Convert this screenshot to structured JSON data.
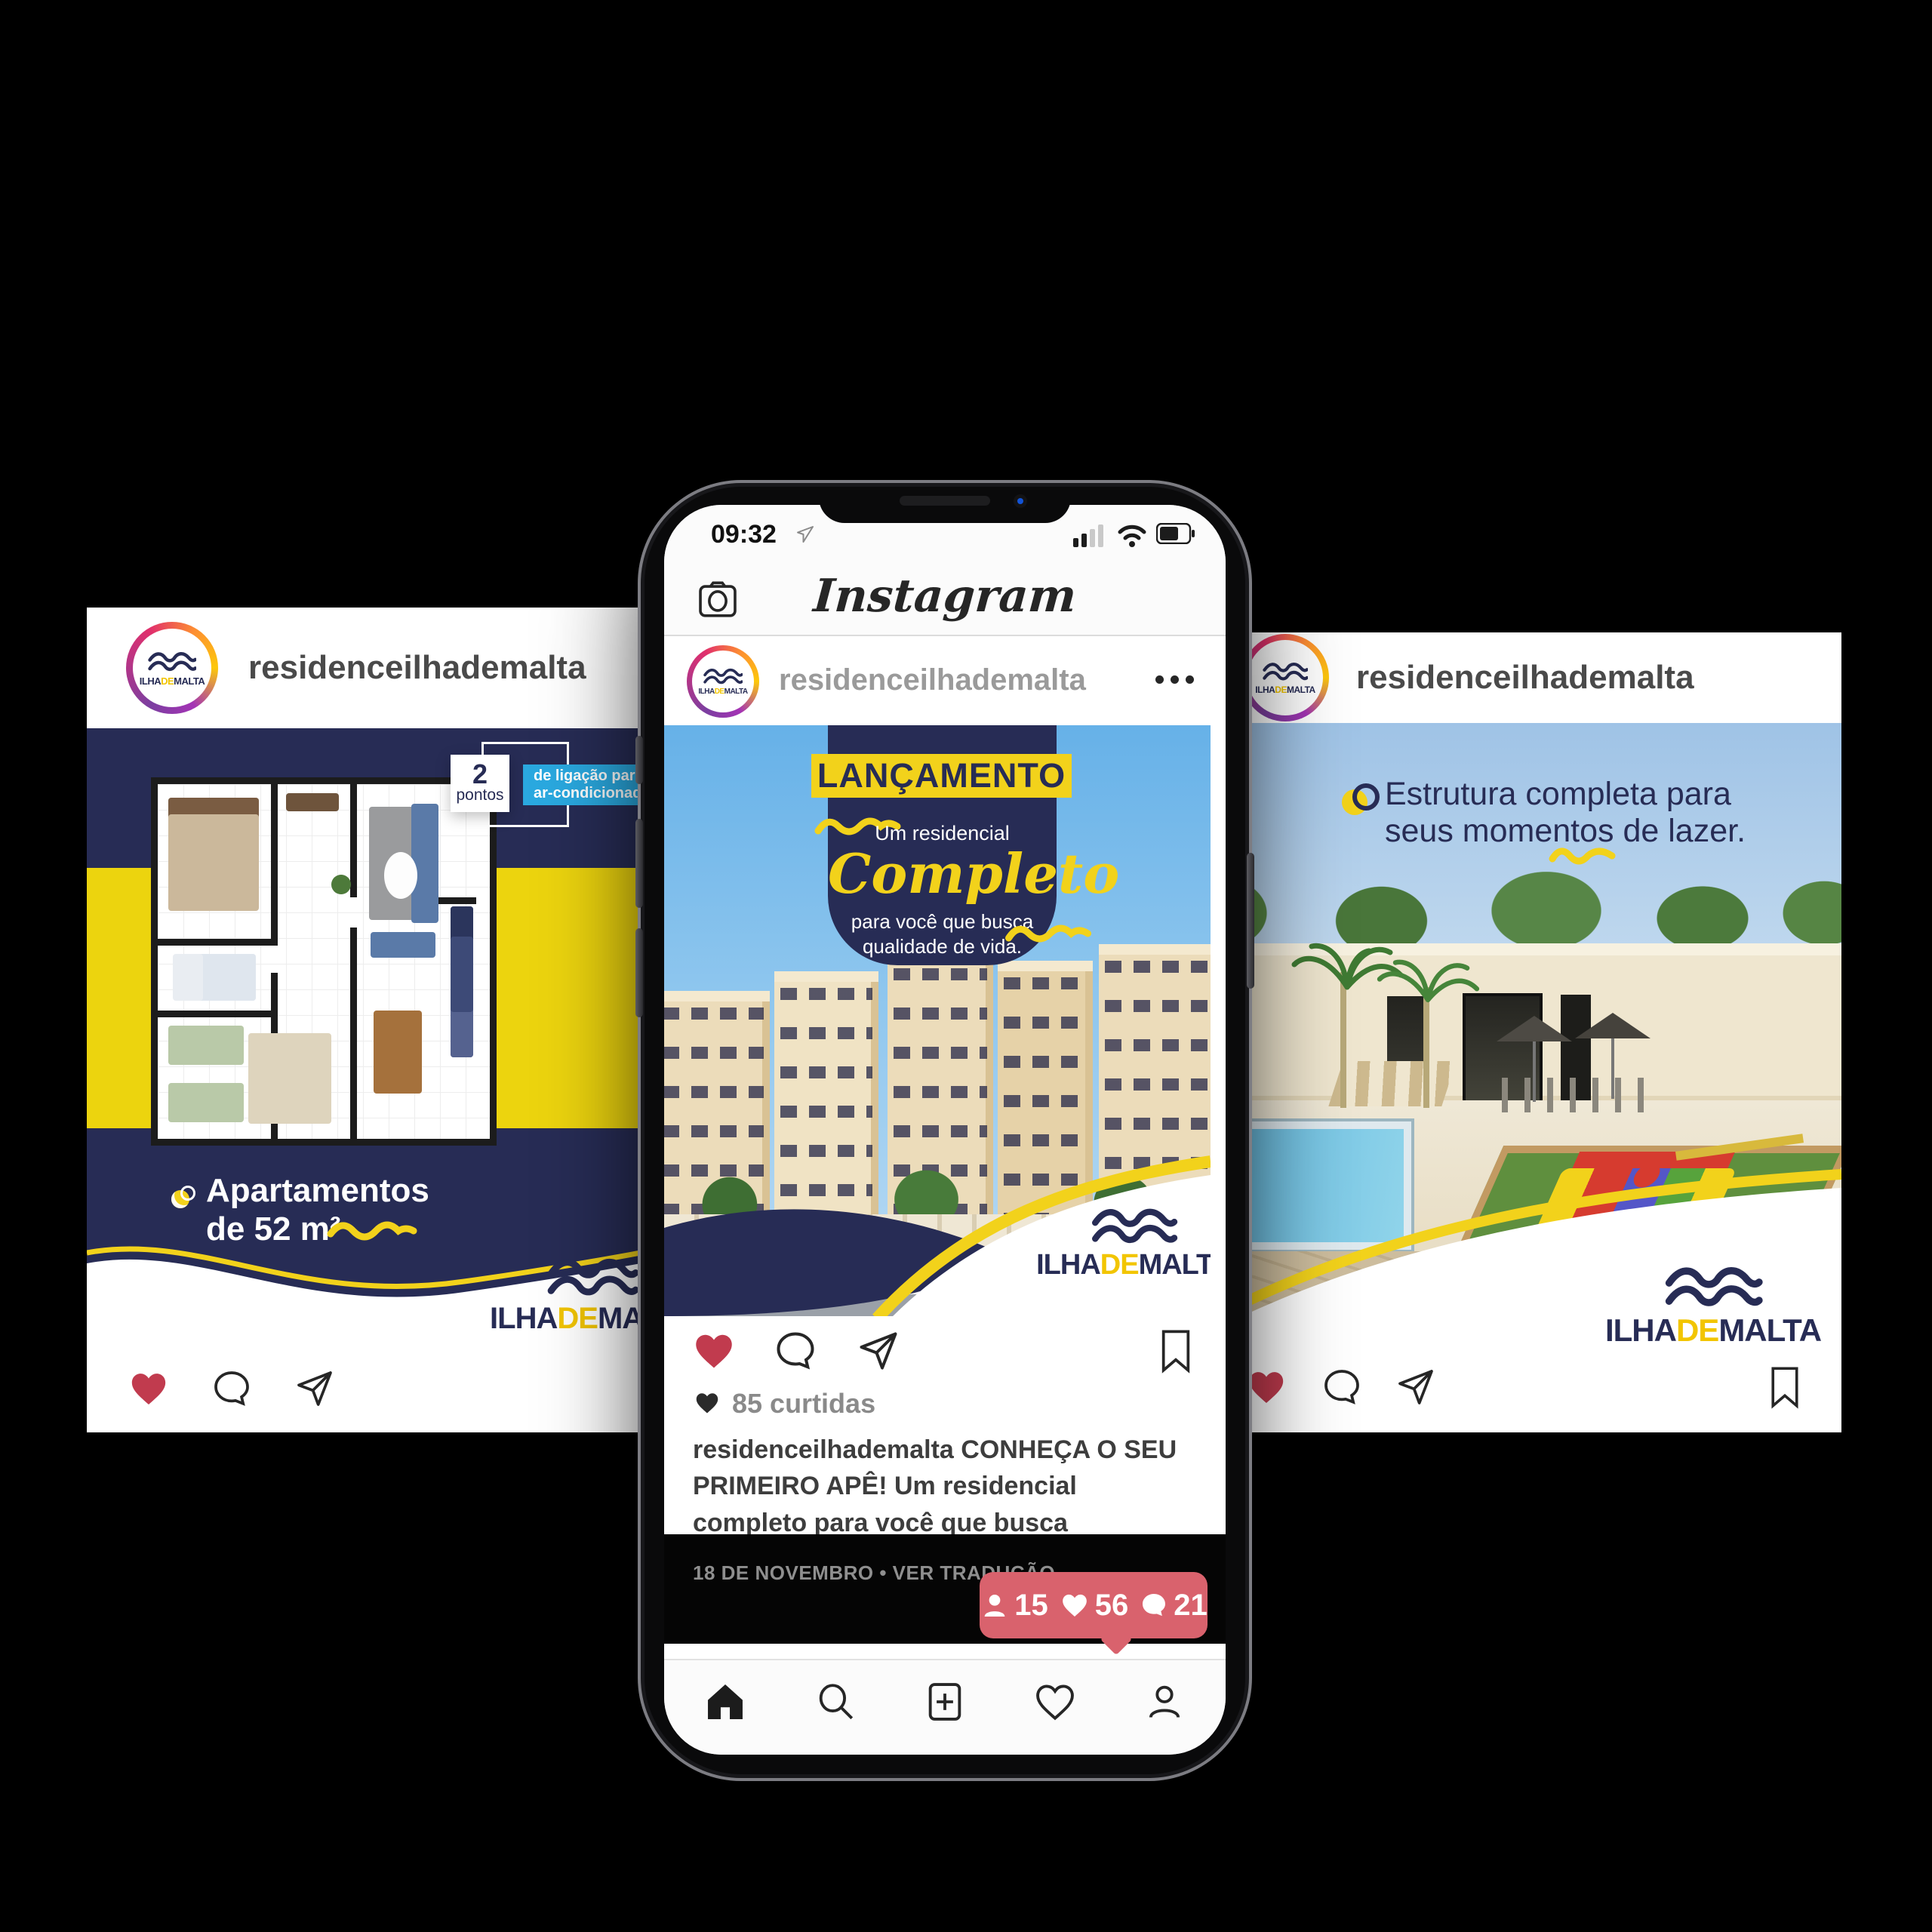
{
  "brand": {
    "ilha": "ILHA",
    "de": "DE",
    "malta": "MALTA"
  },
  "phone": {
    "status": {
      "time": "09:32"
    },
    "app_bar": {
      "logo": "Instagram"
    },
    "post": {
      "username": "residenceilhademalta",
      "banner_title": "LANÇAMENTO",
      "banner_line1": "Um residencial",
      "banner_script": "Completo",
      "banner_line2a": "para você que busca",
      "banner_line2b": "qualidade de vida.",
      "likes": "85 curtidas",
      "caption_user": "residenceilhademalta",
      "caption_text": "CONHEÇA O SEU PRIMEIRO APÊ!  Um residencial completo para você que busca qualidade de vida em localização ..",
      "see_more": "ver mais",
      "meta": "18 DE NOVEMBRO • VER TRADUÇÃO",
      "badge": {
        "follows": "15",
        "likes": "56",
        "comments": "21"
      }
    }
  },
  "left_post": {
    "username": "residenceilhademalta",
    "callout_number": "2",
    "callout_label": "pontos",
    "ribbon_line1": "de ligação para",
    "ribbon_line2": "ar-condicionado Split",
    "feature_line1": "Apartamentos",
    "feature_line2": "de 52 m²"
  },
  "right_post": {
    "username": "residenceilhademalta",
    "feature_line1": "Estrutura completa para",
    "feature_line2": "seus momentos de lazer."
  },
  "colors": {
    "navy": "#272c55",
    "yellow": "#f2d21b",
    "cyan": "#2aa9e0",
    "heart_red": "#c13b4e",
    "badge_red": "#d9626d",
    "sky": "#8ec6ee"
  }
}
